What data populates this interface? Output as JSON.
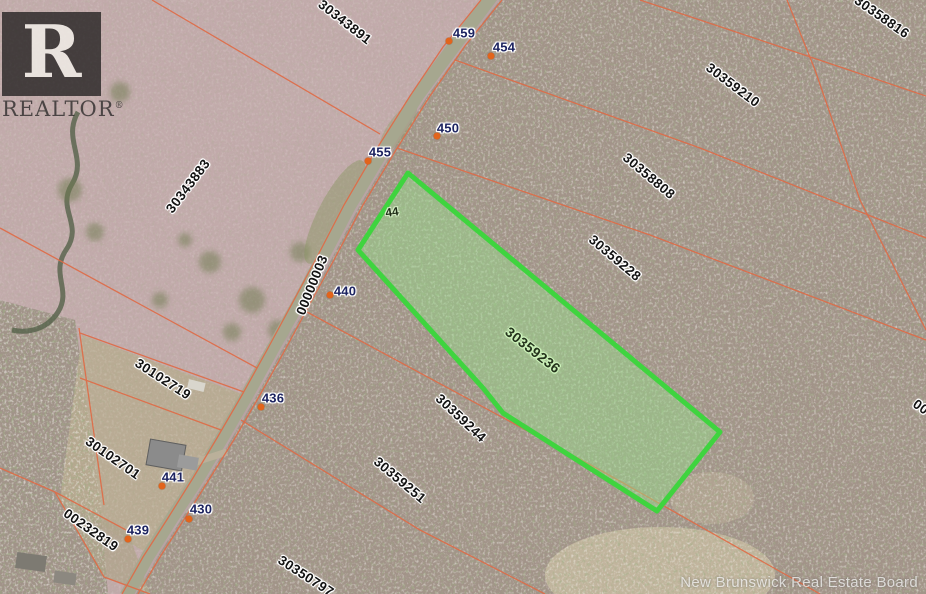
{
  "branding": {
    "logo_letter": "R",
    "logo_word": "REALTOR",
    "logo_registered_mark": "®",
    "board_credit": "New Brunswick Real Estate Board"
  },
  "colors": {
    "highlight_border": "#3fd43f",
    "highlight_fill": "rgba(150,225,140,0.45)",
    "boundary_line": "#e06a45",
    "road_fill": "#a6a78f",
    "civic_dot": "#e2641c",
    "parcel_label_color": "#121212",
    "civic_label_color": "#1c2360"
  },
  "map": {
    "highlighted_parcel": {
      "text": "30359236",
      "x": 533,
      "y": 350,
      "rot": 38
    },
    "lot_number": {
      "text": "44",
      "x": 392,
      "y": 212,
      "rot": -8
    },
    "parcel_labels": [
      {
        "text": "30343891",
        "x": 345,
        "y": 22,
        "rot": 38
      },
      {
        "text": "30358816",
        "x": 882,
        "y": 17,
        "rot": 35
      },
      {
        "text": "30359210",
        "x": 733,
        "y": 85,
        "rot": 37
      },
      {
        "text": "30358808",
        "x": 649,
        "y": 176,
        "rot": 40
      },
      {
        "text": "30343883",
        "x": 188,
        "y": 186,
        "rot": -53
      },
      {
        "text": "30359228",
        "x": 615,
        "y": 258,
        "rot": 40
      },
      {
        "text": "00000003",
        "x": 312,
        "y": 285,
        "rot": -68
      },
      {
        "text": "30102719",
        "x": 163,
        "y": 379,
        "rot": 33
      },
      {
        "text": "30359244",
        "x": 461,
        "y": 418,
        "rot": 43
      },
      {
        "text": "30102701",
        "x": 113,
        "y": 458,
        "rot": 35
      },
      {
        "text": "30359251",
        "x": 400,
        "y": 480,
        "rot": 40
      },
      {
        "text": "00232819",
        "x": 91,
        "y": 530,
        "rot": 35
      },
      {
        "text": "30350797",
        "x": 306,
        "y": 576,
        "rot": 33
      },
      {
        "text": "00",
        "x": 921,
        "y": 407,
        "rot": 35
      }
    ],
    "civic_numbers": [
      {
        "text": "459",
        "x": 464,
        "y": 33,
        "dot_x": 449,
        "dot_y": 41
      },
      {
        "text": "454",
        "x": 504,
        "y": 47,
        "dot_x": 491,
        "dot_y": 56
      },
      {
        "text": "450",
        "x": 448,
        "y": 128,
        "dot_x": 437,
        "dot_y": 136
      },
      {
        "text": "455",
        "x": 380,
        "y": 152,
        "dot_x": 368,
        "dot_y": 161
      },
      {
        "text": "440",
        "x": 345,
        "y": 291,
        "dot_x": 330,
        "dot_y": 295
      },
      {
        "text": "436",
        "x": 273,
        "y": 398,
        "dot_x": 261,
        "dot_y": 407
      },
      {
        "text": "441",
        "x": 173,
        "y": 477,
        "dot_x": 162,
        "dot_y": 486
      },
      {
        "text": "430",
        "x": 201,
        "y": 509,
        "dot_x": 189,
        "dot_y": 519
      },
      {
        "text": "439",
        "x": 138,
        "y": 530,
        "dot_x": 128,
        "dot_y": 539
      }
    ]
  }
}
